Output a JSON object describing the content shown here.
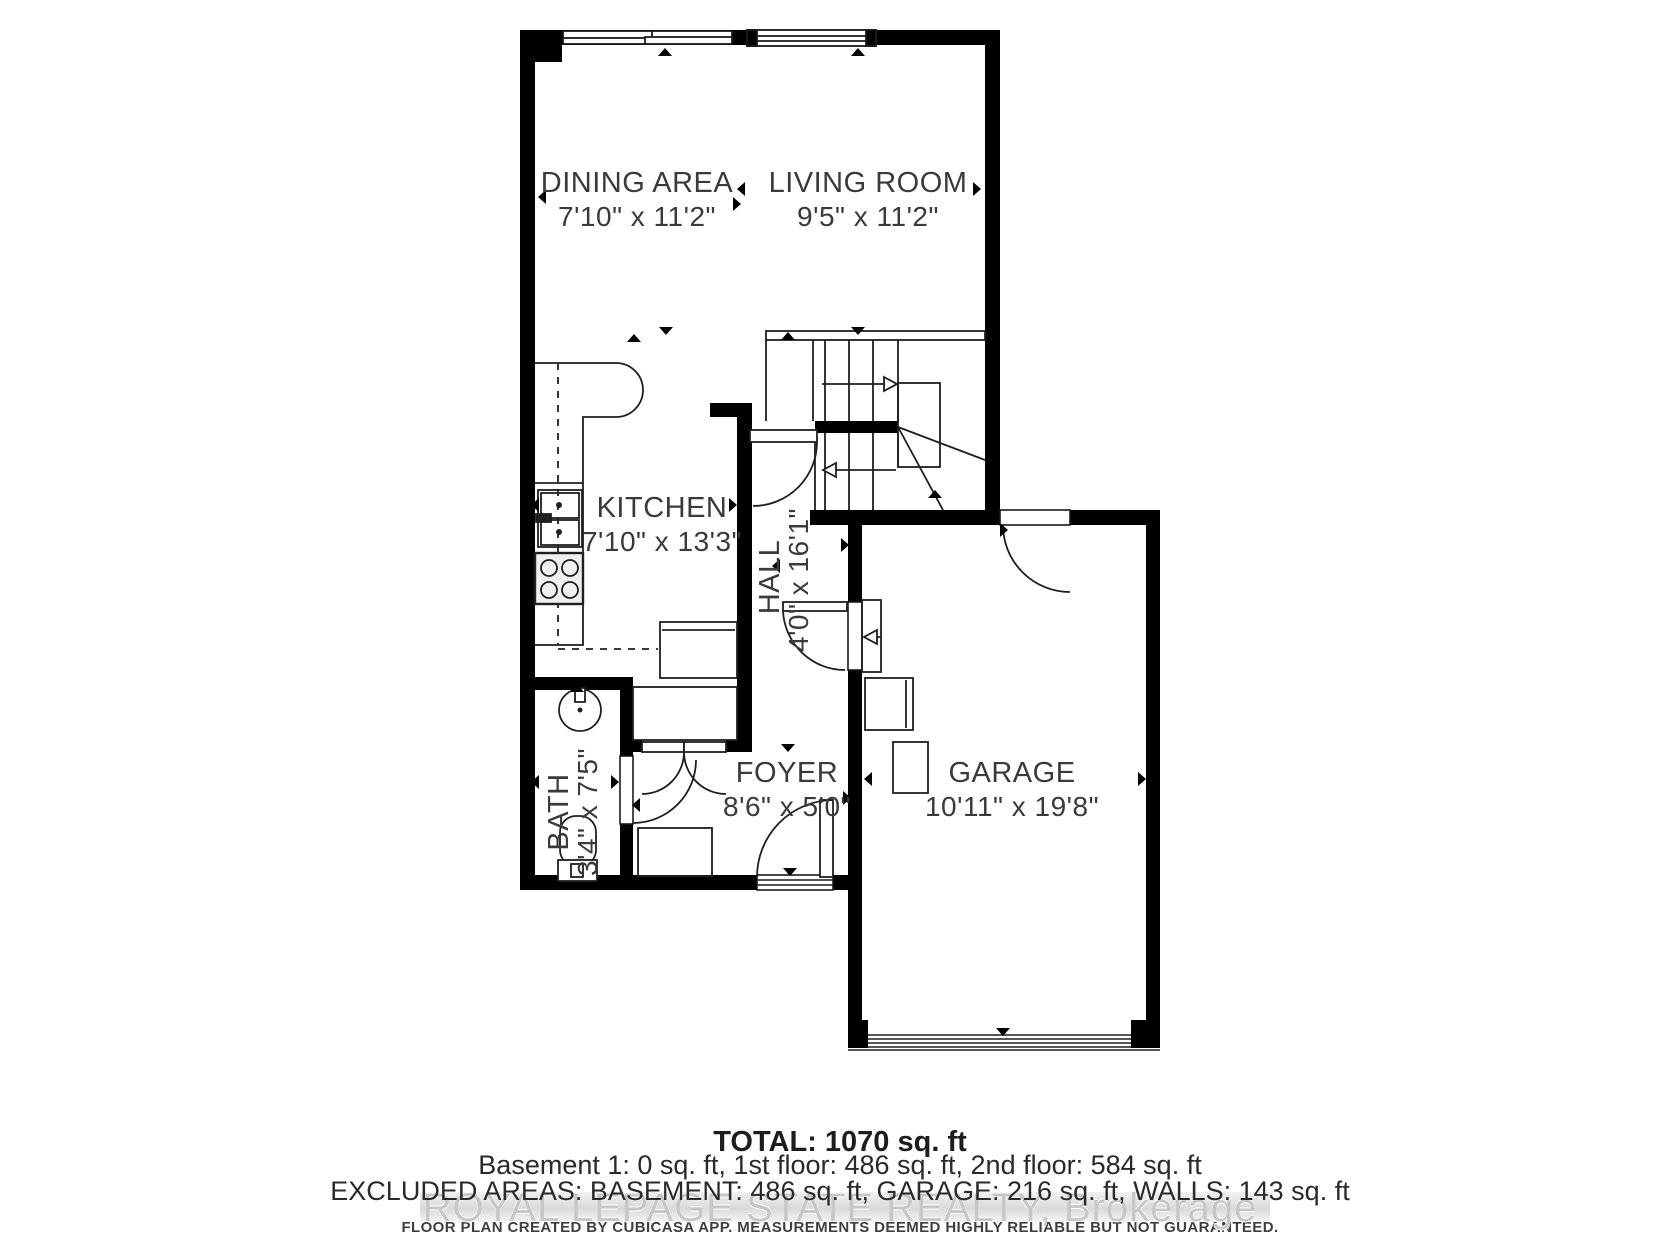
{
  "plan": {
    "rooms": [
      {
        "name": "DINING AREA",
        "dims": "7'10\" x 11'2\""
      },
      {
        "name": "LIVING ROOM",
        "dims": "9'5\" x 11'2\""
      },
      {
        "name": "KITCHEN",
        "dims": "7'10\" x 13'3\""
      },
      {
        "name": "HALL",
        "dims": "4'0\" x 16'1\""
      },
      {
        "name": "BATH",
        "dims": "3'4\" x 7'5\""
      },
      {
        "name": "FOYER",
        "dims": "8'6\" x 5'0\""
      },
      {
        "name": "GARAGE",
        "dims": "10'11\" x 19'8\""
      }
    ],
    "summary": {
      "total": "TOTAL: 1070 sq. ft",
      "floors": "Basement 1: 0 sq. ft, 1st floor: 486 sq. ft, 2nd floor: 584 sq. ft",
      "excluded": "EXCLUDED AREAS: BASEMENT: 486 sq. ft, GARAGE: 216 sq. ft, WALLS: 143 sq. ft"
    },
    "watermark": "ROYAL LEPAGE STATE REALTY, Brokerage",
    "disclaimer": "FLOOR PLAN CREATED BY CUBICASA APP. MEASUREMENTS DEEMED HIGHLY RELIABLE BUT NOT GUARANTEED.",
    "colors": {
      "wall": "#000000",
      "label": "#3a3a3a",
      "watermark": "#c7c7c7"
    }
  }
}
